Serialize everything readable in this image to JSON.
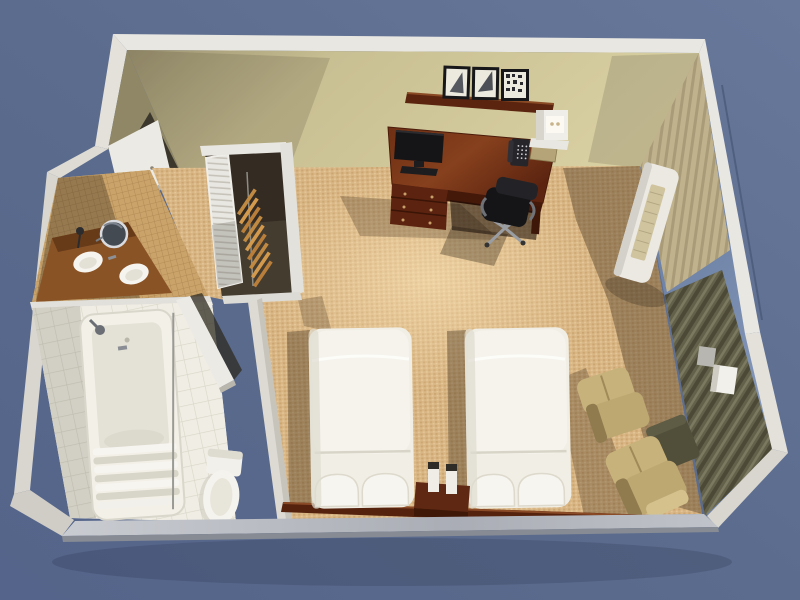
{
  "meta": {
    "description": "3D cutaway top-down rendering of a hotel guest room floor plan with two twin beds, work desk, closet and bathroom",
    "view": "isometric overhead render",
    "visible_text": []
  },
  "palette": {
    "background_top": "#6b7b9c",
    "background_bottom": "#55658a",
    "wall_top_white": "#e9e7e1",
    "wall_top_gray": "#b4b7bd",
    "wall_face_khaki": "#cdc498",
    "wall_face_shadow": "#8f8766",
    "carpet_base": "#d9b685",
    "carpet_dot": "#c1985f",
    "carpet_light": "#eccf9f",
    "wood_dark": "#55220e",
    "wood_mid": "#7a3a1a",
    "bed_white": "#f1eee5",
    "pillow_white": "#f7f5ef",
    "chair_tan": "#c8b27b",
    "drape_olive": "#63614a",
    "curtain_tan": "#c0b28c",
    "glass_blue": "#7186aa",
    "ac_white": "#ece9e3",
    "ac_grille": "#cfc49e",
    "tile_white": "#f0ede4",
    "mosaic_tan": "#c9a36a",
    "counter_brown": "#8a5326",
    "closet_dark": "#453c30",
    "hanger_wood": "#c08a42",
    "fixture_white": "#f3f0e8",
    "tv_black": "#151517",
    "door_white": "#eceae4"
  },
  "room": {
    "areas": [
      {
        "id": "bedroom",
        "label": "bedroom with two twin beds"
      },
      {
        "id": "bathroom",
        "label": "bathroom with tub, toilet and vanity"
      },
      {
        "id": "closet",
        "label": "closet with hangers"
      },
      {
        "id": "entry",
        "label": "entry corridor"
      }
    ],
    "furniture": [
      {
        "id": "bed-1",
        "label": "twin bed with two pillows"
      },
      {
        "id": "bed-2",
        "label": "twin bed with two pillows"
      },
      {
        "id": "nightstand",
        "label": "nightstand with lamps"
      },
      {
        "id": "headboard",
        "label": "shared wood headboard"
      },
      {
        "id": "desk",
        "label": "work desk with TV, phone and notepad"
      },
      {
        "id": "office-chair",
        "label": "office chair"
      },
      {
        "id": "wall-shelf",
        "label": "wall shelf with three framed pictures"
      },
      {
        "id": "desk-lamp",
        "label": "wall mounted cube lamp"
      },
      {
        "id": "armchair-1",
        "label": "upholstered armchair"
      },
      {
        "id": "armchair-2",
        "label": "upholstered armchair"
      },
      {
        "id": "side-table",
        "label": "dark side table"
      },
      {
        "id": "ac-unit",
        "label": "wall air-conditioning unit"
      },
      {
        "id": "window",
        "label": "floor-to-ceiling window"
      },
      {
        "id": "drapes",
        "label": "dark olive drapes"
      },
      {
        "id": "sheer-curtain",
        "label": "tan sheer curtain"
      },
      {
        "id": "bathtub",
        "label": "bathtub with shower curtain"
      },
      {
        "id": "toilet",
        "label": "toilet"
      },
      {
        "id": "vanity",
        "label": "vanity counter with two sinks and mirror"
      },
      {
        "id": "entry-door",
        "label": "entry door, ajar"
      },
      {
        "id": "bathroom-door",
        "label": "bathroom door, open"
      },
      {
        "id": "louver-door",
        "label": "louvered closet door, open"
      }
    ]
  }
}
